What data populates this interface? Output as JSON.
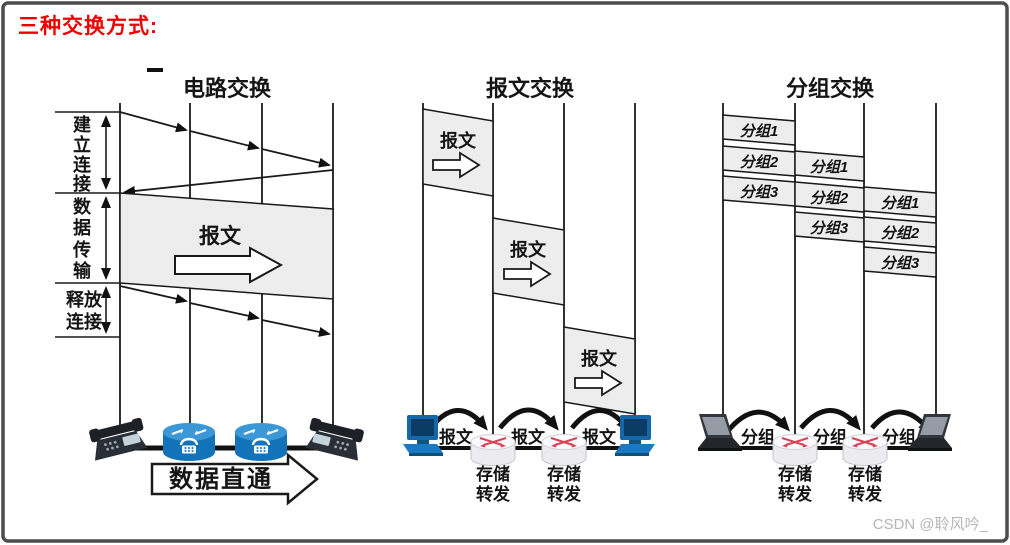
{
  "header": {
    "title": "三种交换方式:"
  },
  "watermark": "CSDN @聆风吟_",
  "circuit": {
    "title": "电路交换",
    "phase1_chars": [
      "建",
      "立",
      "连",
      "接"
    ],
    "phase2_chars": [
      "数",
      "据",
      "传",
      "输"
    ],
    "phase3_lines": [
      "释放",
      "连接"
    ],
    "band_label": "报文",
    "direct_label": "数据直通"
  },
  "message": {
    "title": "报文交换",
    "blocks": [
      "报文",
      "报文",
      "报文"
    ],
    "hops": [
      "报文",
      "报文",
      "报文"
    ],
    "store_forward": [
      "存储",
      "转发"
    ]
  },
  "packet": {
    "title": "分组交换",
    "columns": [
      [
        "分组1",
        "分组2",
        "分组3"
      ],
      [
        "分组1",
        "分组2",
        "分组3"
      ],
      [
        "分组1",
        "分组2",
        "分组3"
      ]
    ],
    "hops": [
      "分组",
      "分组",
      "分组"
    ],
    "store_forward": [
      "存储",
      "转发"
    ]
  },
  "colors": {
    "accent_red": "#ee0000",
    "device_blue": "#1273b8",
    "router_arrow_red": "#d84456",
    "fill_gray": "#ededed"
  }
}
